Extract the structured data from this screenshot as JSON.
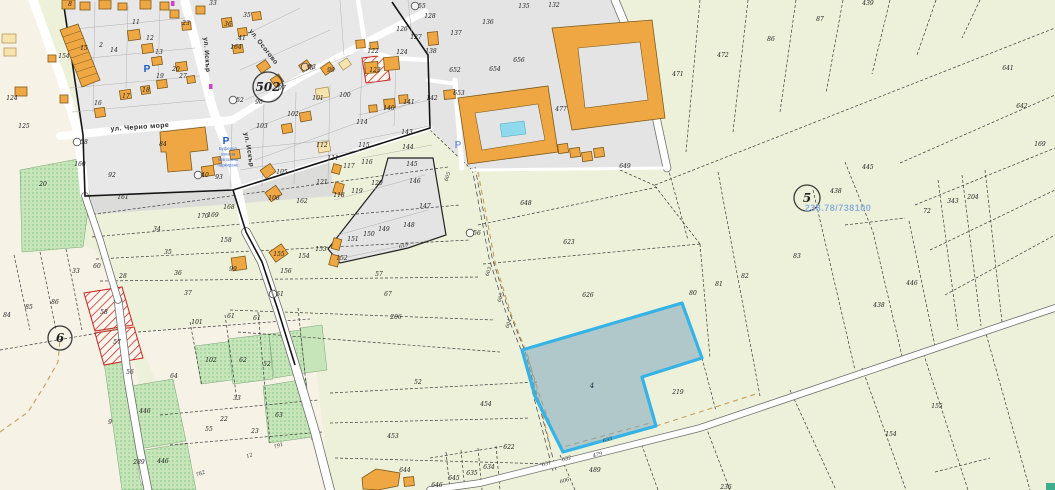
{
  "map_title": "Кадастрална карта",
  "colors": {
    "agri": "#eef1da",
    "cream": "#f6f2e6",
    "urban": "#e8e8e8",
    "complex": "#e4e4e4",
    "wedge": "#dcdcda",
    "green_parcel": "#c6e6ba",
    "green_dot": "#7cbd7c",
    "building_orange": "#efa743",
    "building_outline": "#7d5a1a",
    "building_pale": "#f7e3ae",
    "pool_blue": "#8fd9ec",
    "hatch_red": "#cc2222",
    "selected_stroke": "#35b3e6",
    "selected_fill": "rgba(125,165,190,0.55)",
    "ref_text_blue": "#8ab0dc",
    "parking_blue": "#1a56c4",
    "road_line": "#555555",
    "tan_dash": "#c3a05c",
    "poi_magenta": "#cc44cc",
    "teal_patch": "#3fae8f"
  },
  "selected_parcel": {
    "label": "4",
    "x": 592,
    "y": 388
  },
  "ref_note": {
    "text": "238.78/738100",
    "x": 838,
    "y": 211
  },
  "zone_circles": [
    {
      "label": "502",
      "x": 268,
      "y": 87,
      "r": 15
    },
    {
      "label": "5",
      "x": 807,
      "y": 198,
      "r": 13
    },
    {
      "label": "6",
      "x": 60,
      "y": 338,
      "r": 12
    }
  ],
  "node_points": [
    [
      "53",
      305,
      67
    ],
    [
      "52",
      233,
      100
    ],
    [
      "40",
      198,
      175
    ],
    [
      "56",
      470,
      233
    ],
    [
      "61",
      273,
      294
    ],
    [
      "55",
      415,
      6
    ],
    [
      "58",
      77,
      142
    ]
  ],
  "streets": [
    {
      "name": "ул. Черно море",
      "x": 140,
      "y": 129,
      "angle": -4
    },
    {
      "name": "ул. Искър",
      "x": 205,
      "y": 55,
      "angle": 86
    },
    {
      "name": "ул. Искър",
      "x": 247,
      "y": 150,
      "angle": 80
    },
    {
      "name": "ул. Осогово",
      "x": 262,
      "y": 48,
      "angle": 52
    }
  ],
  "parking": {
    "p_label": "P",
    "icons": [
      {
        "x": 147,
        "y": 69
      },
      {
        "x": 226,
        "y": 141
      },
      {
        "x": 458,
        "y": 145
      }
    ],
    "note_x": 228,
    "note_y": 149,
    "note_lines": [
      "Буферна",
      "зона за",
      "безплатно",
      "паркиране"
    ]
  },
  "parcel_labels": [
    [
      "8",
      70,
      6
    ],
    [
      "11",
      136,
      24
    ],
    [
      "12",
      150,
      40
    ],
    [
      "13",
      159,
      54
    ],
    [
      "14",
      114,
      52
    ],
    [
      "15",
      84,
      50
    ],
    [
      "23",
      186,
      25
    ],
    [
      "33",
      213,
      5
    ],
    [
      "35",
      247,
      17
    ],
    [
      "36",
      228,
      26
    ],
    [
      "41",
      242,
      40
    ],
    [
      "164",
      236,
      49
    ],
    [
      "19",
      160,
      78
    ],
    [
      "20",
      176,
      71
    ],
    [
      "27",
      183,
      78
    ],
    [
      "17",
      126,
      98
    ],
    [
      "18",
      146,
      92
    ],
    [
      "16",
      98,
      105
    ],
    [
      "124",
      12,
      100
    ],
    [
      "125",
      24,
      128
    ],
    [
      "154",
      64,
      58
    ],
    [
      "2",
      101,
      47
    ],
    [
      "96",
      259,
      104
    ],
    [
      "97",
      282,
      90
    ],
    [
      "55",
      310,
      70
    ],
    [
      "99",
      331,
      72
    ],
    [
      "101",
      318,
      100
    ],
    [
      "100",
      345,
      97
    ],
    [
      "102",
      293,
      116
    ],
    [
      "103",
      262,
      128
    ],
    [
      "112",
      322,
      147
    ],
    [
      "111",
      333,
      160
    ],
    [
      "84",
      163,
      146
    ],
    [
      "93",
      219,
      179
    ],
    [
      "160",
      80,
      166
    ],
    [
      "92",
      112,
      177
    ],
    [
      "161",
      123,
      199
    ],
    [
      "20",
      43,
      186
    ],
    [
      "105",
      282,
      174
    ],
    [
      "106",
      274,
      200
    ],
    [
      "162",
      302,
      203
    ],
    [
      "121",
      322,
      184
    ],
    [
      "168",
      229,
      209
    ],
    [
      "169",
      213,
      217
    ],
    [
      "170",
      203,
      218
    ],
    [
      "158",
      226,
      242
    ],
    [
      "99",
      233,
      271
    ],
    [
      "155",
      279,
      256
    ],
    [
      "154",
      304,
      258
    ],
    [
      "153",
      321,
      251
    ],
    [
      "156",
      286,
      273
    ],
    [
      "135",
      524,
      8
    ],
    [
      "132",
      554,
      7
    ],
    [
      "136",
      488,
      24
    ],
    [
      "137",
      456,
      35
    ],
    [
      "128",
      430,
      18
    ],
    [
      "138",
      431,
      53
    ],
    [
      "127",
      416,
      39
    ],
    [
      "126",
      402,
      31
    ],
    [
      "122",
      373,
      53
    ],
    [
      "123",
      375,
      72
    ],
    [
      "124",
      402,
      54
    ],
    [
      "652",
      455,
      72
    ],
    [
      "654",
      495,
      71
    ],
    [
      "656",
      519,
      62
    ],
    [
      "653",
      459,
      95
    ],
    [
      "477",
      561,
      111
    ],
    [
      "471",
      678,
      76
    ],
    [
      "141",
      409,
      104
    ],
    [
      "140",
      389,
      110
    ],
    [
      "114",
      362,
      124
    ],
    [
      "115",
      364,
      147
    ],
    [
      "143",
      407,
      134
    ],
    [
      "144",
      408,
      149
    ],
    [
      "142",
      432,
      100
    ],
    [
      "145",
      412,
      166
    ],
    [
      "146",
      415,
      183
    ],
    [
      "147",
      425,
      208
    ],
    [
      "148",
      409,
      227
    ],
    [
      "149",
      384,
      231
    ],
    [
      "150",
      369,
      236
    ],
    [
      "151",
      353,
      241
    ],
    [
      "152",
      342,
      260
    ],
    [
      "116",
      367,
      164
    ],
    [
      "117",
      349,
      168
    ],
    [
      "119",
      357,
      193
    ],
    [
      "120",
      377,
      185
    ],
    [
      "118",
      339,
      197
    ],
    [
      "648",
      526,
      205
    ],
    [
      "649",
      625,
      168
    ],
    [
      "623",
      569,
      244
    ],
    [
      "626",
      588,
      297
    ],
    [
      "80",
      693,
      295
    ],
    [
      "57",
      379,
      276
    ],
    [
      "67",
      388,
      296
    ],
    [
      "206",
      396,
      319
    ],
    [
      "52",
      418,
      384
    ],
    [
      "454",
      486,
      406
    ],
    [
      "453",
      393,
      438
    ],
    [
      "622",
      509,
      449
    ],
    [
      "634",
      489,
      469
    ],
    [
      "635",
      472,
      475
    ],
    [
      "645",
      454,
      480
    ],
    [
      "646",
      437,
      487
    ],
    [
      "644",
      405,
      472
    ],
    [
      "489",
      595,
      472
    ],
    [
      "219",
      678,
      394
    ],
    [
      "236",
      726,
      489
    ],
    [
      "155",
      937,
      408
    ],
    [
      "154",
      891,
      436
    ],
    [
      "472",
      723,
      57
    ],
    [
      "86",
      771,
      41
    ],
    [
      "87",
      820,
      21
    ],
    [
      "439",
      868,
      5
    ],
    [
      "641",
      1008,
      70
    ],
    [
      "642",
      1022,
      108
    ],
    [
      "169",
      1040,
      146
    ],
    [
      "445",
      868,
      169
    ],
    [
      "438",
      836,
      193
    ],
    [
      "72",
      927,
      213
    ],
    [
      "343",
      953,
      203
    ],
    [
      "204",
      973,
      199
    ],
    [
      "83",
      797,
      258
    ],
    [
      "82",
      745,
      278
    ],
    [
      "81",
      719,
      286
    ],
    [
      "446",
      912,
      285
    ],
    [
      "438",
      879,
      307
    ],
    [
      "58",
      104,
      314
    ],
    [
      "57",
      117,
      344
    ],
    [
      "56",
      130,
      374
    ],
    [
      "64",
      174,
      378
    ],
    [
      "101",
      197,
      324
    ],
    [
      "61",
      231,
      318
    ],
    [
      "61",
      257,
      320
    ],
    [
      "102",
      211,
      362
    ],
    [
      "62",
      243,
      362
    ],
    [
      "52",
      267,
      366
    ],
    [
      "33",
      237,
      400
    ],
    [
      "22",
      224,
      421
    ],
    [
      "23",
      255,
      433
    ],
    [
      "55",
      209,
      431
    ],
    [
      "63",
      279,
      417
    ],
    [
      "446",
      145,
      413
    ],
    [
      "9",
      110,
      424
    ],
    [
      "446",
      163,
      463
    ],
    [
      "289",
      139,
      464
    ],
    [
      "84",
      7,
      317
    ],
    [
      "85",
      29,
      309
    ],
    [
      "86",
      55,
      304
    ],
    [
      "34",
      157,
      231
    ],
    [
      "35",
      168,
      254
    ],
    [
      "36",
      178,
      275
    ],
    [
      "37",
      188,
      295
    ],
    [
      "33",
      76,
      273
    ],
    [
      "60",
      97,
      268
    ],
    [
      "28",
      123,
      278
    ],
    [
      "605",
      449,
      177,
      -72
    ],
    [
      "603",
      490,
      272,
      -72
    ],
    [
      "607",
      502,
      298,
      -72
    ],
    [
      "604",
      510,
      324,
      -72
    ],
    [
      "631",
      547,
      465,
      -16
    ],
    [
      "632",
      567,
      460,
      -16
    ],
    [
      "479",
      598,
      456,
      -16
    ],
    [
      "633",
      608,
      441,
      -16
    ],
    [
      "606",
      565,
      482,
      -16
    ],
    [
      "791",
      279,
      447,
      -20
    ],
    [
      "12",
      250,
      457,
      -20
    ],
    [
      "782",
      201,
      475,
      -20
    ],
    [
      "615",
      404,
      247,
      -18
    ]
  ]
}
